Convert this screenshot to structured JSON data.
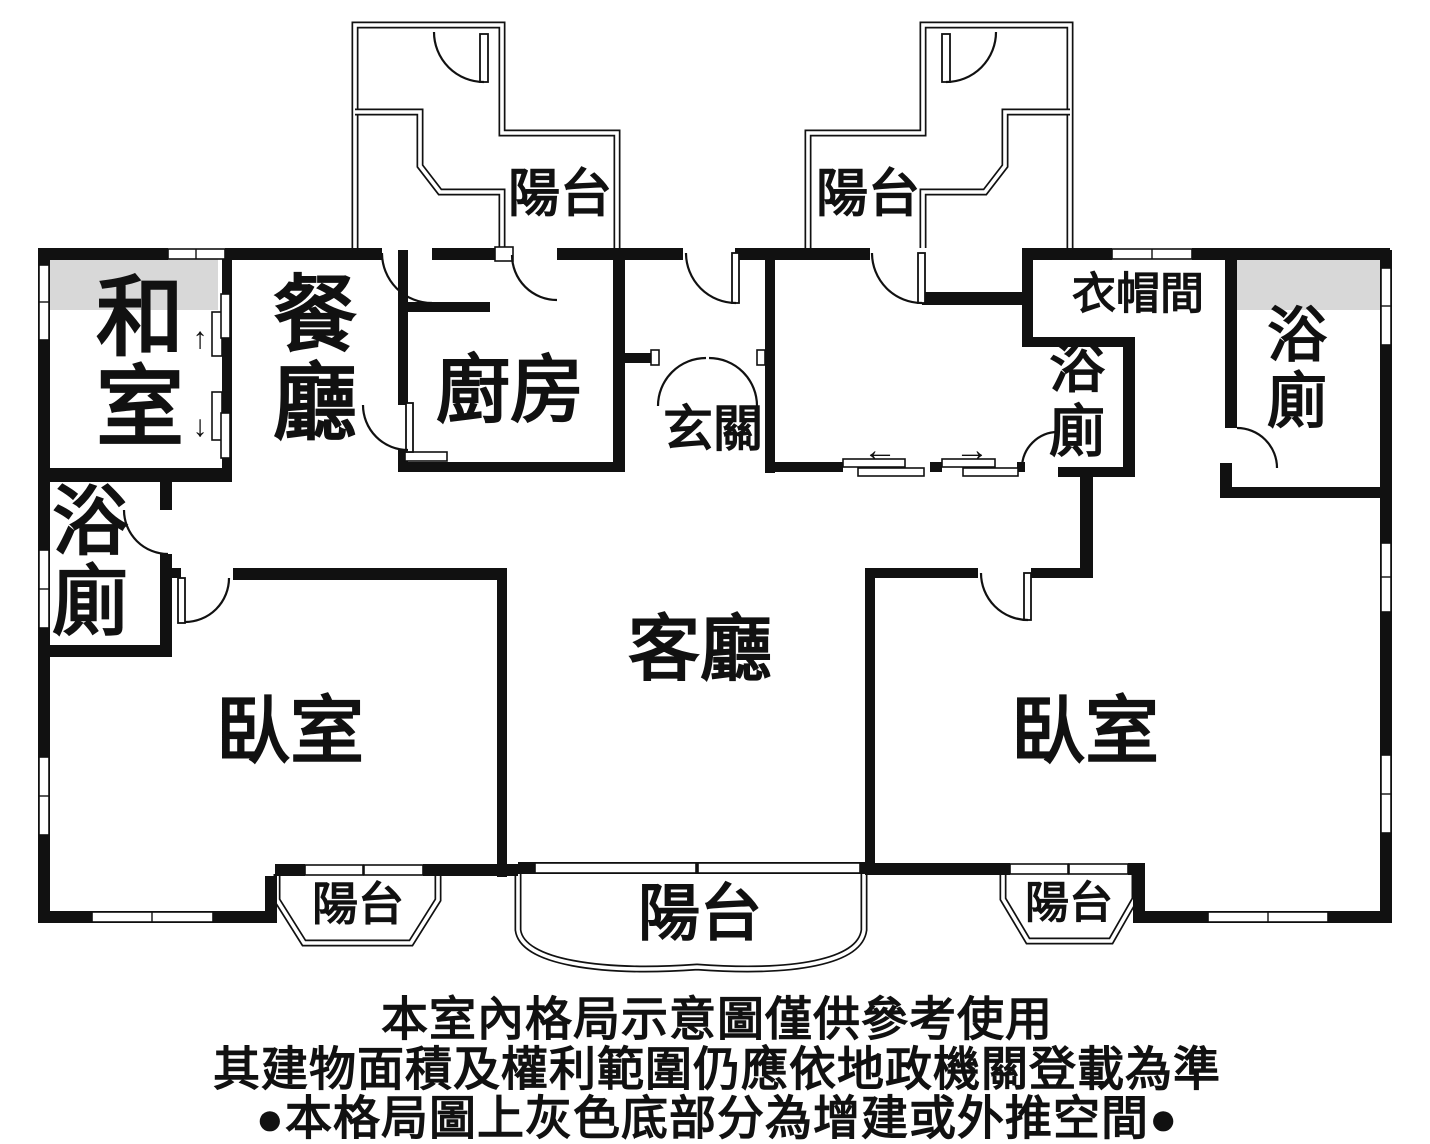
{
  "rooms": {
    "tatami": "和室",
    "dining": "餐廳",
    "kitchen": "廚房",
    "foyer": "玄關",
    "living": "客廳",
    "bedroom_left": "臥室",
    "bedroom_right": "臥室",
    "bath_left": "浴廁",
    "bath_inner": "浴廁",
    "bath_right": "浴廁",
    "closet": "衣帽間"
  },
  "balconies": {
    "top_left": "陽台",
    "top_right": "陽台",
    "bottom_left": "陽台",
    "bottom_center": "陽台",
    "bottom_right": "陽台"
  },
  "arrows": {
    "up": "↑",
    "down": "↓",
    "left": "←",
    "right": "→"
  },
  "footnotes": {
    "line1": "本室內格局示意圖僅供參考使用",
    "line2": "其建物面積及權利範圍仍應依地政機關登載為準",
    "line3": "●本格局圖上灰色底部分為增建或外推空間●"
  },
  "colors": {
    "gray_zone": "#d8d8d8",
    "note_blue": "#3d4da0",
    "wall_black": "#111111"
  }
}
